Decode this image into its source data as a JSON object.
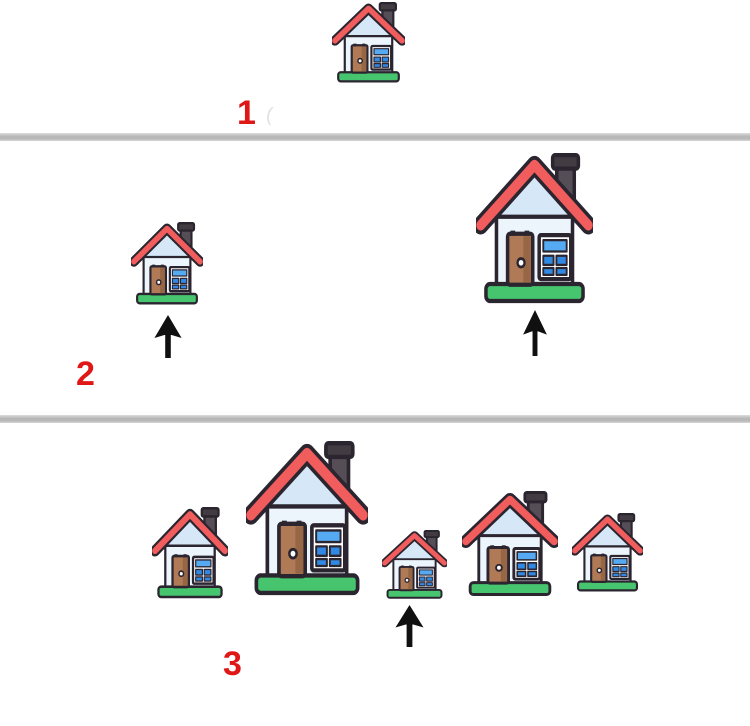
{
  "figure": {
    "description": "Three-panel illustration of cartoon houses; arrows point at selected houses",
    "background": "#ffffff",
    "divider_color": "#bdbdbd",
    "faint_mark": "("
  },
  "colors": {
    "roof_red": "#f15c5c",
    "outline": "#2b2530",
    "gable_blue": "#d6e8f8",
    "wall_blue": "#ecf4fc",
    "door_brown": "#b07a56",
    "door_brown_dark": "#976644",
    "window_light": "#55aaf2",
    "window_blue": "#3189e4",
    "window_frame": "#ffffff",
    "base_green": "#46c46e",
    "chimney_gray": "#564e56",
    "chimney_cap": "#423c42",
    "label_red": "#e01717",
    "arrow_black": "#101010"
  },
  "icons": {
    "house": "house-icon",
    "arrow": "arrow-up-icon"
  },
  "sections": [
    {
      "label": "1",
      "houses": [
        {
          "size": "medium",
          "x": 332,
          "y": 2,
          "w": 73,
          "h": 82,
          "arrow": null
        }
      ]
    },
    {
      "label": "2",
      "houses": [
        {
          "size": "small",
          "x": 131,
          "y": 222,
          "w": 72,
          "h": 84,
          "arrow": {
            "x": 152,
            "y": 315,
            "w": 32,
            "h": 43
          }
        },
        {
          "size": "large",
          "x": 476,
          "y": 153,
          "w": 117,
          "h": 153,
          "arrow": {
            "x": 521,
            "y": 310,
            "w": 28,
            "h": 46
          }
        }
      ]
    },
    {
      "label": "3",
      "houses": [
        {
          "size": "medium-small",
          "x": 152,
          "y": 507,
          "w": 76,
          "h": 93,
          "arrow": null
        },
        {
          "size": "largest",
          "x": 246,
          "y": 441,
          "w": 122,
          "h": 157,
          "arrow": null
        },
        {
          "size": "smallest",
          "x": 382,
          "y": 530,
          "w": 65,
          "h": 70,
          "arrow": {
            "x": 393,
            "y": 605,
            "w": 33,
            "h": 42
          }
        },
        {
          "size": "medium",
          "x": 462,
          "y": 491,
          "w": 96,
          "h": 107,
          "arrow": null
        },
        {
          "size": "small",
          "x": 572,
          "y": 513,
          "w": 71,
          "h": 80,
          "arrow": null
        }
      ]
    }
  ]
}
